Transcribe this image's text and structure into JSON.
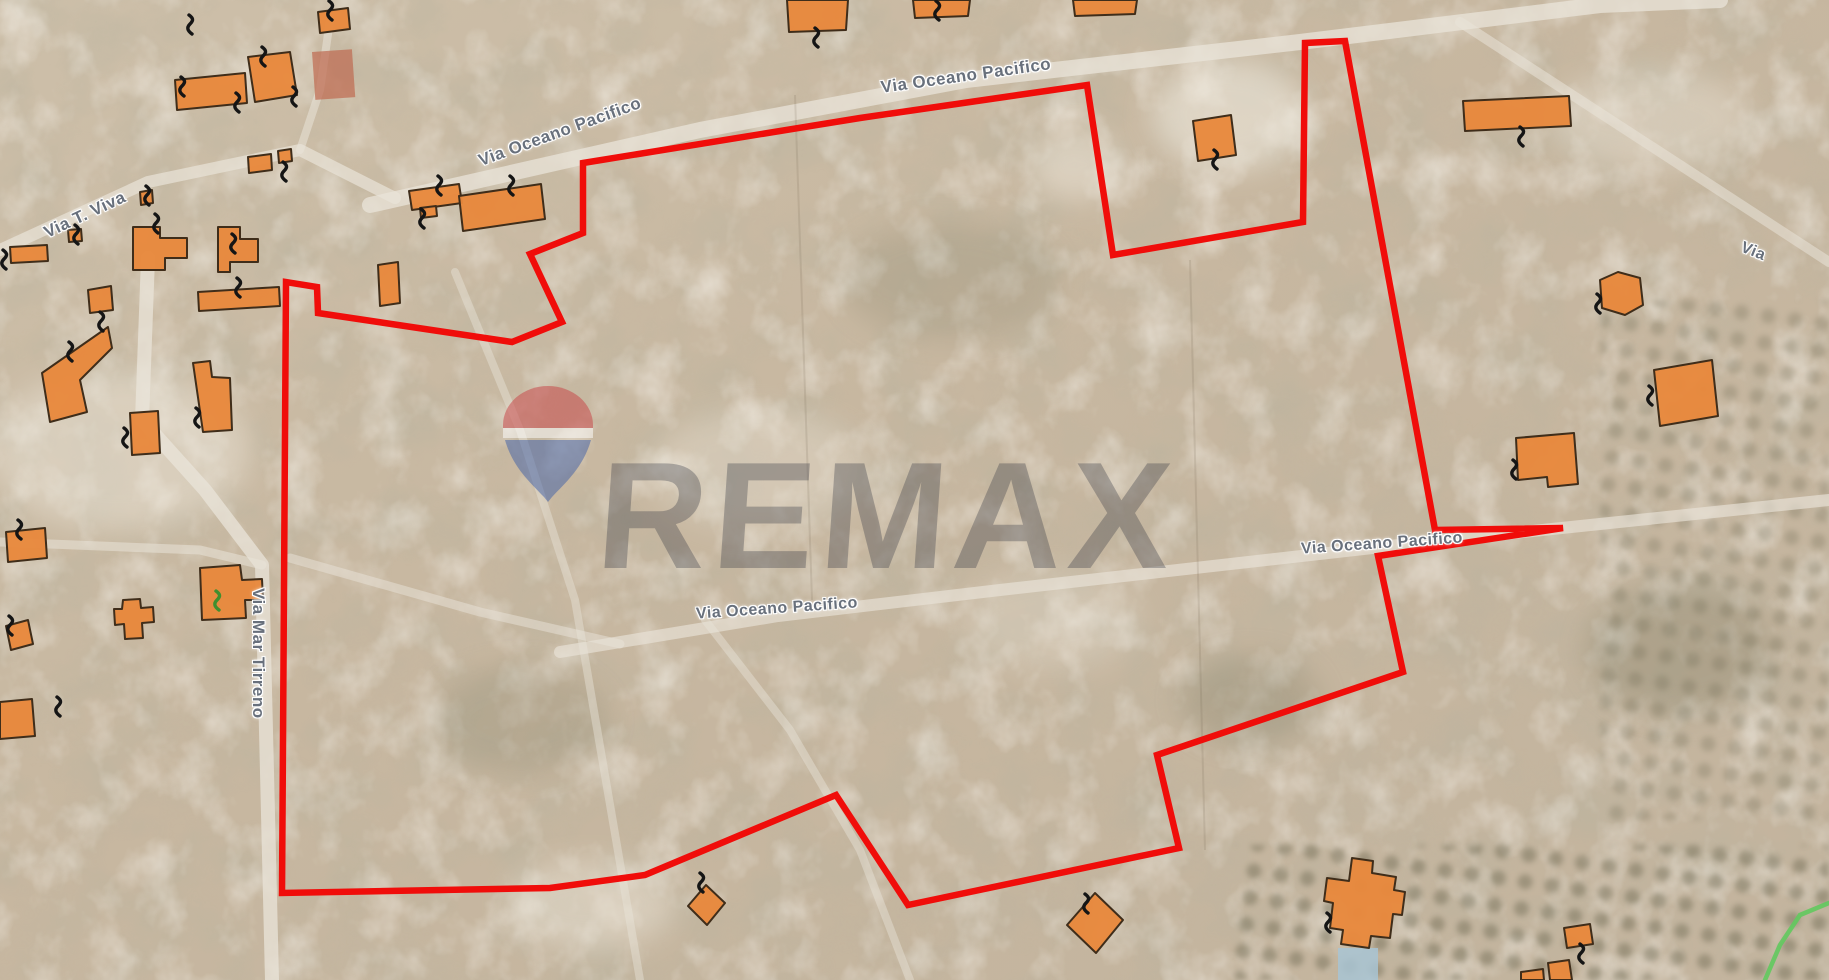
{
  "map": {
    "description": "satellite-cadastral-map",
    "colors": {
      "terrain_base": "#c9baa5",
      "terrain_dark": "#7e7a60",
      "terrain_light": "#efe9dd",
      "road_fill": "#e9e4d9",
      "boundary_red": "#f00d0a",
      "building_fill": "#e8883c",
      "building_stroke": "#3f2d1a",
      "marker_black": "#151515",
      "marker_green": "#3f8f2f",
      "label_gray": "#68707c",
      "pool_blue": "#a8c4d4",
      "court_clay": "#bf6a50",
      "green_path": "#62c95e"
    },
    "watermark": {
      "text": "REMAX",
      "balloon_red": "#c84043",
      "balloon_blue": "#3f5fa8",
      "balloon_white": "#ffffff"
    },
    "boundary": {
      "stroke_width": 6.5,
      "points": "583,163 860,118 1087,85 1113,255 1303,222 1305,43 1345,41 1435,530 1563,528 1378,556 1403,672 1157,755 1179,848 908,905 836,795 645,875 550,888 282,893 286,282 317,287 318,313 512,342 562,322 530,254 583,233"
    },
    "labels": [
      {
        "text": "Via Oceano Pacifico",
        "x": 560,
        "y": 132,
        "rotation": -20,
        "size": 17
      },
      {
        "text": "Via Oceano Pacifico",
        "x": 966,
        "y": 76,
        "rotation": -8,
        "size": 17
      },
      {
        "text": "Via Oceano Pacifico",
        "x": 777,
        "y": 609,
        "rotation": -4,
        "size": 16
      },
      {
        "text": "Via Oceano Pacifico",
        "x": 1382,
        "y": 544,
        "rotation": -4,
        "size": 16
      },
      {
        "text": "Via T. Viva",
        "x": 85,
        "y": 215,
        "rotation": -25,
        "size": 17
      },
      {
        "text": "Via Mar Tirreno",
        "x": 268,
        "y": 588,
        "rotation": 90,
        "size": 17
      },
      {
        "text": "Via",
        "x": 1753,
        "y": 252,
        "rotation": 22,
        "size": 16
      }
    ],
    "roads": [
      {
        "points": "370,205 700,130 966,80 1300,42 1600,5 1720,0",
        "width": 16,
        "opacity": 0.75
      },
      {
        "points": "560,652 778,616 1000,590 1390,546 1829,500",
        "width": 12,
        "opacity": 0.65
      },
      {
        "points": "290,558 480,612 620,644",
        "width": 9,
        "opacity": 0.5
      },
      {
        "points": "705,620 790,730 860,850 910,980",
        "width": 8,
        "opacity": 0.45
      },
      {
        "points": "455,272 520,430 575,600 640,980",
        "width": 8,
        "opacity": 0.45
      },
      {
        "points": "148,258 142,420 205,490 262,565 272,980",
        "width": 14,
        "opacity": 0.75
      },
      {
        "points": "0,250 148,182 300,150 395,198",
        "width": 12,
        "opacity": 0.7
      },
      {
        "points": "300,150 320,90 330,20",
        "width": 8,
        "opacity": 0.55
      },
      {
        "points": "0,542 200,550 262,565",
        "width": 9,
        "opacity": 0.55
      },
      {
        "points": "1460,22 1700,178 1829,262",
        "width": 10,
        "opacity": 0.55
      }
    ],
    "field_lines": [
      {
        "points": "795,95 812,600",
        "opacity": 0.15
      },
      {
        "points": "1190,260 1205,850",
        "opacity": 0.15
      }
    ],
    "buildings": [
      {
        "points": "318,12 348,8 350,29 320,33"
      },
      {
        "points": "787,0 848,0 846,30 789,32"
      },
      {
        "points": "913,0 970,0 968,16 915,18"
      },
      {
        "points": "1073,0 1137,0 1135,14 1075,16"
      },
      {
        "points": "248,57 290,52 297,95 255,102"
      },
      {
        "points": "175,80 245,73 247,103 177,110"
      },
      {
        "points": "140,192 152,190 153,203 141,205"
      },
      {
        "points": "278,151 291,149 292,161 279,163"
      },
      {
        "points": "248,157 271,154 272,170 249,173"
      },
      {
        "points": "409,191 459,184 462,203 412,210"
      },
      {
        "points": "420,208 436,206 437,216 421,218"
      },
      {
        "points": "459,196 541,184 545,219 463,231"
      },
      {
        "points": "378,265 398,262 400,303 380,306"
      },
      {
        "points": "218,227 240,227 240,239 258,239 258,262 230,262 230,272 218,272"
      },
      {
        "points": "133,227 160,227 160,238 187,238 187,258 165,258 165,270 133,270"
      },
      {
        "points": "68,230 81,229 82,241 69,242"
      },
      {
        "points": "10,247 47,245 48,261 11,263"
      },
      {
        "points": "88,290 111,286 113,310 90,313"
      },
      {
        "points": "198,292 279,287 280,306 199,311"
      },
      {
        "points": "108,327 42,373 50,422 87,412 80,380 112,348"
      },
      {
        "points": "193,363 210,361 212,377 230,378 232,430 203,432"
      },
      {
        "points": "130,413 158,411 160,453 132,455"
      },
      {
        "points": "200,568 240,565 242,580 262,579 263,600 245,600 246,618 202,620"
      },
      {
        "points": "123,600 140,599 141,608 153,607 154,622 142,623 143,638 125,639 124,624 115,625 114,609 122,609"
      },
      {
        "points": "6,532 45,528 47,558 8,562"
      },
      {
        "points": "6,626 28,620 33,644 11,650"
      },
      {
        "points": "0,702 32,699 35,736 0,739"
      },
      {
        "points": "1193,121 1231,115 1236,155 1198,161"
      },
      {
        "points": "1463,101 1569,96 1571,126 1465,131"
      },
      {
        "points": "1600,280 1618,272 1640,278 1643,305 1625,315 1602,308"
      },
      {
        "points": "1654,370 1712,360 1718,416 1660,426"
      },
      {
        "points": "1516,438 1574,433 1578,484 1548,487 1547,477 1518,480"
      },
      {
        "points": "1095,893 1123,920 1096,953 1067,925"
      },
      {
        "points": "706,885 725,903 707,925 688,906"
      },
      {
        "points": "1352,858 1373,861 1372,873 1396,877 1394,890 1405,892 1402,915 1393,914 1390,938 1371,936 1369,948 1341,944 1343,930 1330,928 1333,903 1324,901 1327,878 1349,881"
      },
      {
        "points": "1564,928 1590,924 1593,944 1567,948"
      },
      {
        "points": "1521,972 1543,969 1544,980 1521,980"
      },
      {
        "points": "1548,963 1569,960 1572,980 1550,980"
      }
    ],
    "markers": [
      {
        "x": 329,
        "y": 1
      },
      {
        "x": 189,
        "y": 15
      },
      {
        "x": 262,
        "y": 47
      },
      {
        "x": 293,
        "y": 87
      },
      {
        "x": 181,
        "y": 77
      },
      {
        "x": 236,
        "y": 93
      },
      {
        "x": 146,
        "y": 186
      },
      {
        "x": 283,
        "y": 162
      },
      {
        "x": 438,
        "y": 176
      },
      {
        "x": 510,
        "y": 176
      },
      {
        "x": 421,
        "y": 209
      },
      {
        "x": 232,
        "y": 234
      },
      {
        "x": 155,
        "y": 214
      },
      {
        "x": 75,
        "y": 225
      },
      {
        "x": 3,
        "y": 250
      },
      {
        "x": 100,
        "y": 312
      },
      {
        "x": 69,
        "y": 342
      },
      {
        "x": 124,
        "y": 428
      },
      {
        "x": 196,
        "y": 408
      },
      {
        "x": 237,
        "y": 278
      },
      {
        "x": 18,
        "y": 520
      },
      {
        "x": 9,
        "y": 616
      },
      {
        "x": 57,
        "y": 697
      },
      {
        "x": 815,
        "y": 28
      },
      {
        "x": 936,
        "y": 1
      },
      {
        "x": 1214,
        "y": 150
      },
      {
        "x": 1520,
        "y": 127
      },
      {
        "x": 1597,
        "y": 294
      },
      {
        "x": 1649,
        "y": 386
      },
      {
        "x": 1513,
        "y": 460
      },
      {
        "x": 1327,
        "y": 913
      },
      {
        "x": 1580,
        "y": 944
      },
      {
        "x": 1085,
        "y": 894
      },
      {
        "x": 700,
        "y": 873
      }
    ],
    "green_marker": {
      "x": 216,
      "y": 591
    },
    "green_path": {
      "points": "1829,903 1800,915 1780,945 1765,980"
    },
    "pool": {
      "x": 1338,
      "y": 948,
      "w": 40,
      "h": 32
    },
    "court": {
      "x": 312,
      "y": 52,
      "w": 40,
      "h": 48
    },
    "light_blobs": [
      {
        "cx": 1230,
        "cy": 115,
        "rx": 78,
        "ry": 55,
        "o": 0.55
      },
      {
        "cx": 1075,
        "cy": 165,
        "rx": 45,
        "ry": 35,
        "o": 0.45
      },
      {
        "cx": 120,
        "cy": 450,
        "rx": 130,
        "ry": 80,
        "o": 0.4
      },
      {
        "cx": 1650,
        "cy": 120,
        "rx": 100,
        "ry": 50,
        "o": 0.35
      },
      {
        "cx": 590,
        "cy": 905,
        "rx": 85,
        "ry": 45,
        "o": 0.4
      },
      {
        "cx": 760,
        "cy": 470,
        "rx": 110,
        "ry": 60,
        "o": 0.3
      },
      {
        "cx": 1050,
        "cy": 620,
        "rx": 90,
        "ry": 50,
        "o": 0.25
      }
    ],
    "dark_blobs": [
      {
        "cx": 1680,
        "cy": 650,
        "rx": 95,
        "ry": 65,
        "o": 0.3
      },
      {
        "cx": 1250,
        "cy": 700,
        "rx": 70,
        "ry": 45,
        "o": 0.28
      },
      {
        "cx": 520,
        "cy": 720,
        "rx": 90,
        "ry": 55,
        "o": 0.22
      },
      {
        "cx": 950,
        "cy": 280,
        "rx": 110,
        "ry": 60,
        "o": 0.2
      }
    ],
    "orchards": [
      {
        "x": 1235,
        "y": 845,
        "w": 594,
        "h": 135,
        "o": 0.45
      },
      {
        "x": 1600,
        "y": 300,
        "w": 229,
        "h": 520,
        "o": 0.28
      }
    ]
  }
}
